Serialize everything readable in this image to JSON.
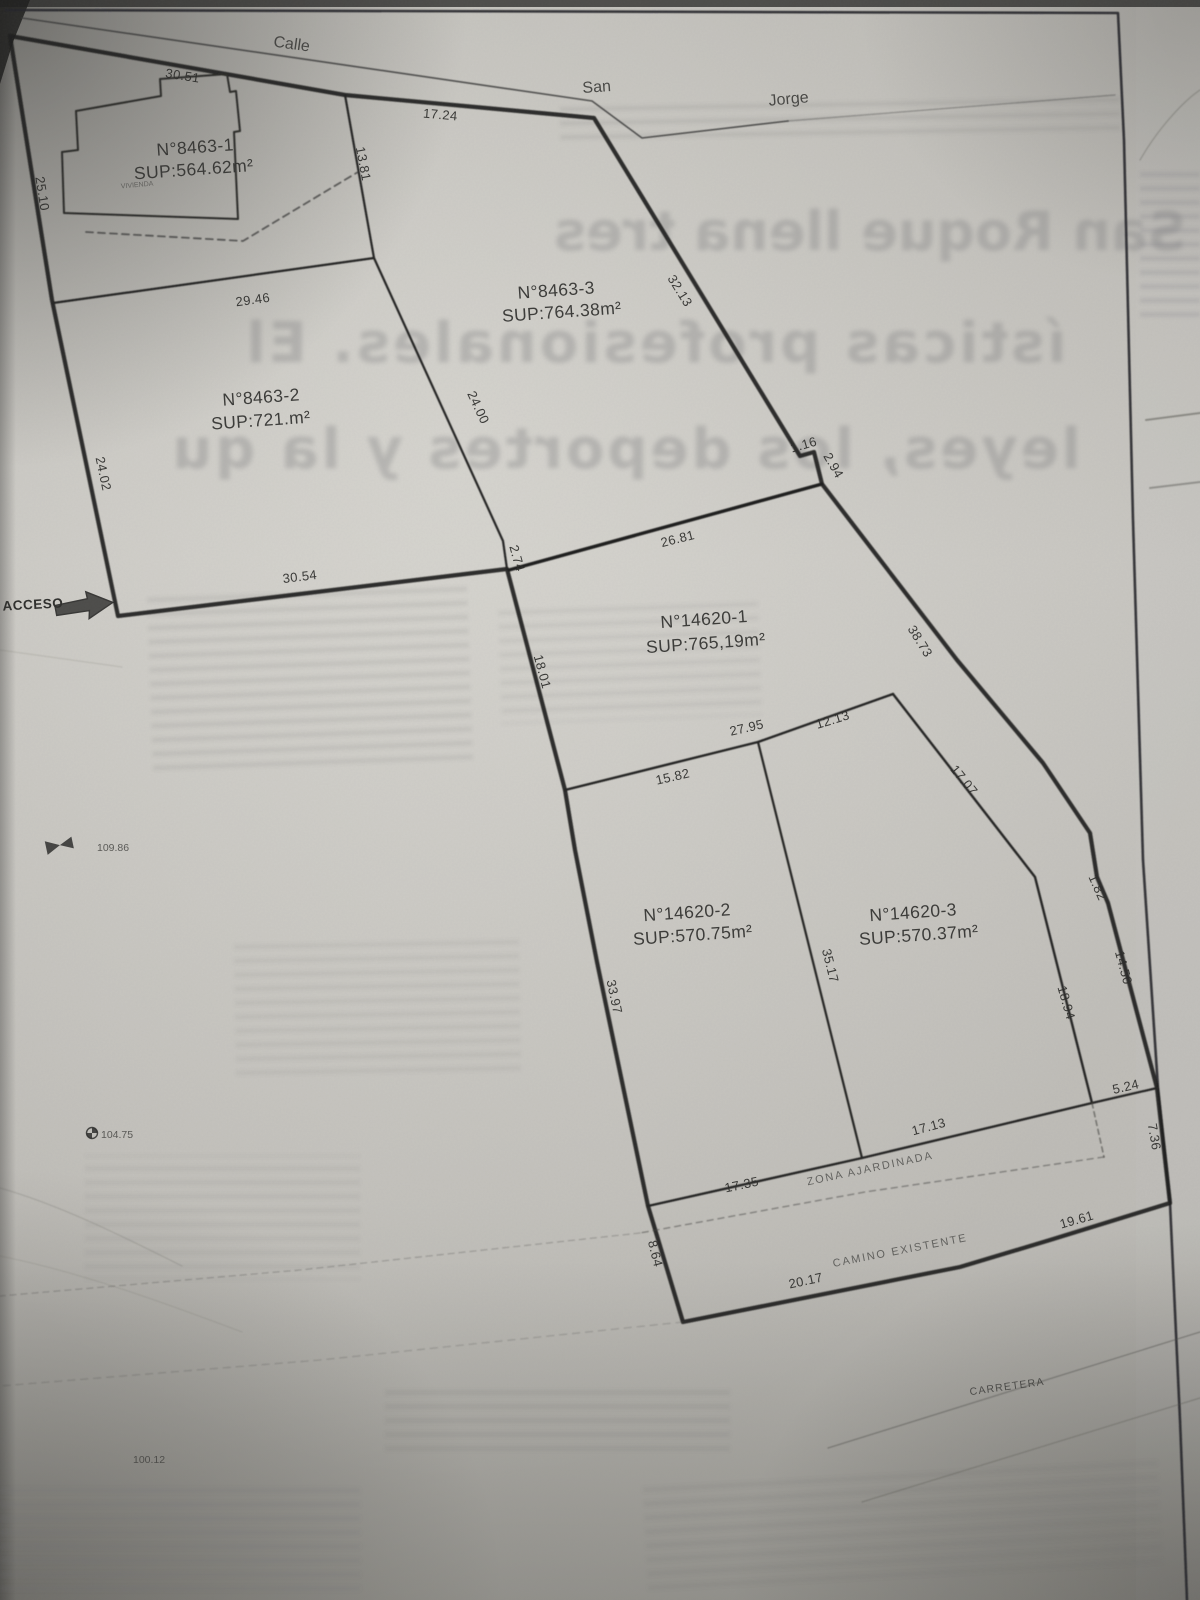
{
  "plan": {
    "street": {
      "calle": "Calle",
      "san": "San",
      "jorge": "Jorge"
    },
    "parcels": [
      {
        "id": "N°8463-1",
        "sup": "SUP:564.62m²"
      },
      {
        "id": "N°8463-2",
        "sup": "SUP:721.m²"
      },
      {
        "id": "N°8463-3",
        "sup": "SUP:764.38m²"
      },
      {
        "id": "N°14620-1",
        "sup": "SUP:765,19m²"
      },
      {
        "id": "N°14620-2",
        "sup": "SUP:570.75m²"
      },
      {
        "id": "N°14620-3",
        "sup": "SUP:570.37m²"
      }
    ],
    "measurements": [
      "30.51",
      "17.24",
      "13.81",
      "32.13",
      "25.10",
      "29.46",
      "24.02",
      "24.00",
      "30.54",
      "2.74",
      "26.81",
      "1.16",
      "2.94",
      "38.73",
      "18.01",
      "27.95",
      "12.13",
      "15.82",
      "17.07",
      "1.82",
      "35.17",
      "33.97",
      "18.94",
      "14.50",
      "5.24",
      "7.36",
      "17.35",
      "17.13",
      "8.64",
      "20.17",
      "19.61"
    ],
    "labels": {
      "acceso": "ACCESO",
      "vivienda": "VIVIENDA",
      "zona": "ZONA AJARDINADA",
      "camino": "CAMINO EXISTENTE",
      "carretera": "CARRETERA"
    },
    "benchmarks": [
      "109.86",
      "104.75",
      "100.12"
    ],
    "ghost": {
      "l1": "San Roque llena tres",
      "l2": "ísticas profesionales. El",
      "l3": "leyes, los deportes y la qu"
    }
  }
}
